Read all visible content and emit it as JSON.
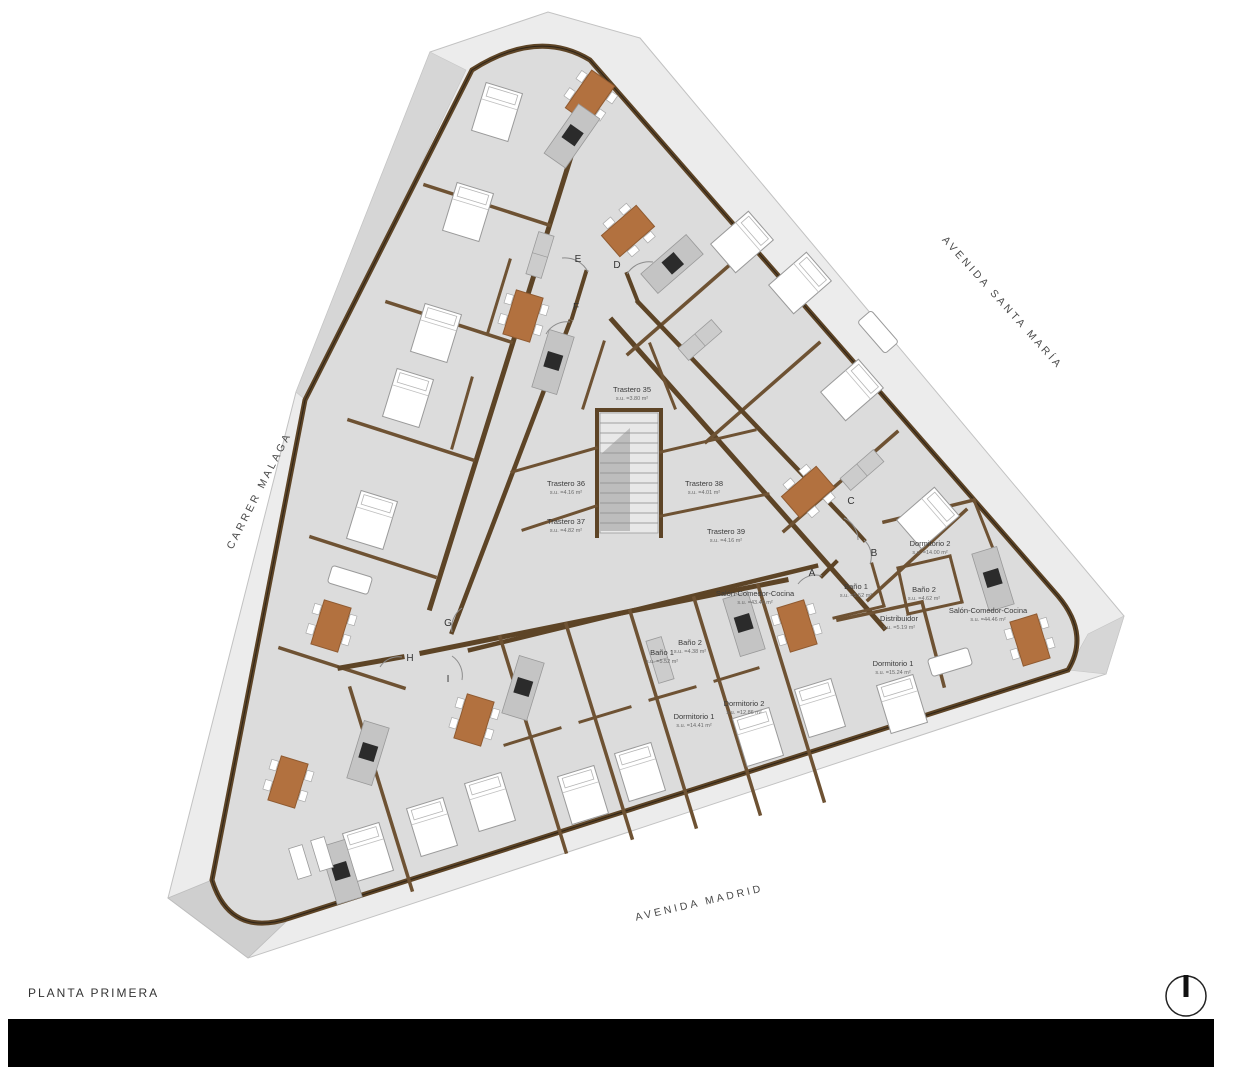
{
  "title": "PLANTA PRIMERA",
  "streets": {
    "right": "AVENIDA SANTA MARÍA",
    "left": "CARRER MALAGA",
    "bottom": "AVENIDA MADRID"
  },
  "rooms": [
    {
      "name": "Trastero 35",
      "area": "s.u. =3.80 m²"
    },
    {
      "name": "Trastero 36",
      "area": "s.u. =4.16 m²"
    },
    {
      "name": "Trastero 37",
      "area": "s.u. =4.82 m²"
    },
    {
      "name": "Trastero 38",
      "area": "s.u. =4.01 m²"
    },
    {
      "name": "Trastero 39",
      "area": "s.u. =4.16 m²"
    },
    {
      "name": "Salón-Comedor-Cocina",
      "area": "s.u. =43.46 m²"
    },
    {
      "name": "Baño 1",
      "area": "s.u. =5.52 m²"
    },
    {
      "name": "Baño 2",
      "area": "s.u. =4.62 m²"
    },
    {
      "name": "Dormitorio 2",
      "area": "s.u. =14.00 m²"
    },
    {
      "name": "Distribuidor",
      "area": "s.u. =5.19 m²"
    },
    {
      "name": "Dormitorio 1",
      "area": "s.u. =15.24 m²"
    },
    {
      "name": "Salón-Comedor-Cocina",
      "area": "s.u. =44.46 m²"
    },
    {
      "name": "Baño 1",
      "area": "s.u. =5.52 m²"
    },
    {
      "name": "Baño 2",
      "area": "s.u. =4.38 m²"
    },
    {
      "name": "Dormitorio 1",
      "area": "s.u. =14.41 m²"
    },
    {
      "name": "Dormitorio 2",
      "area": "s.u. =12.86 m²"
    }
  ],
  "doors": [
    "E",
    "D",
    "F",
    "C",
    "B",
    "A",
    "G",
    "H",
    "I"
  ],
  "north_icon": "north-arrow",
  "colors": {
    "floor": "#dcdcdc",
    "sidewalk": "#ececec",
    "wall": "#5d4426",
    "wood_accent": "#b2713f",
    "title_block": "#000000"
  }
}
